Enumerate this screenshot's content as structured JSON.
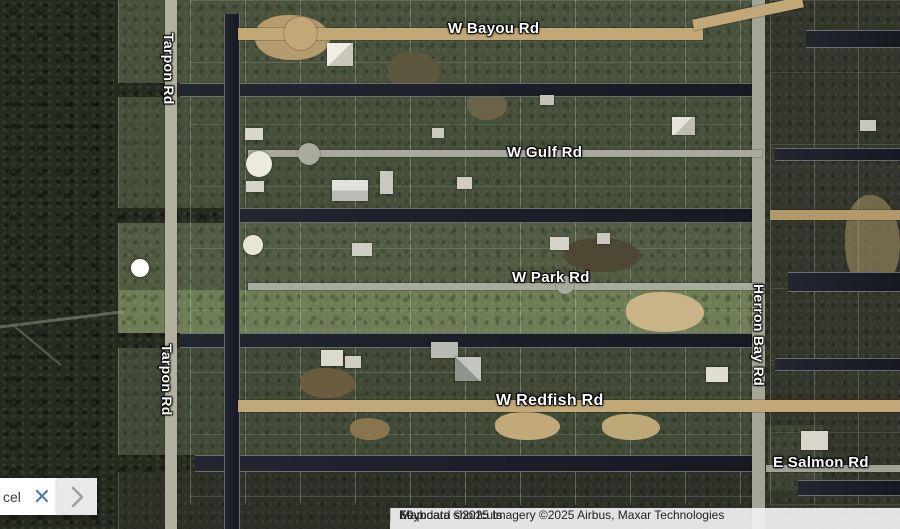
{
  "map": {
    "labels": {
      "bayou": "W Bayou Rd",
      "gulf": "W Gulf Rd",
      "park": "W Park Rd",
      "redfish": "W Redfish Rd",
      "salmon": "E Salmon Rd",
      "tarpon": "Tarpon Rd",
      "herron_bay": "Herron Bay Rd"
    },
    "marker": {
      "type": "dot",
      "color": "#ffffff"
    },
    "icons": {
      "close": "close-x-icon",
      "expand": "chevron-right-icon"
    }
  },
  "card": {
    "text": "cel"
  },
  "attribution": {
    "keyboard_shortcuts": "Keyboard shortcuts",
    "map_data": "Map data ©2025 Imagery ©2025 Airbus, Maxar Technologies",
    "scale": "50 m"
  },
  "colors": {
    "close_icon": "#4c7f92",
    "chevron_icon": "#9aa0a6",
    "canal_water": "#181d27",
    "road_tan": "#c3a877",
    "road_gray": "#a7ab9b"
  }
}
